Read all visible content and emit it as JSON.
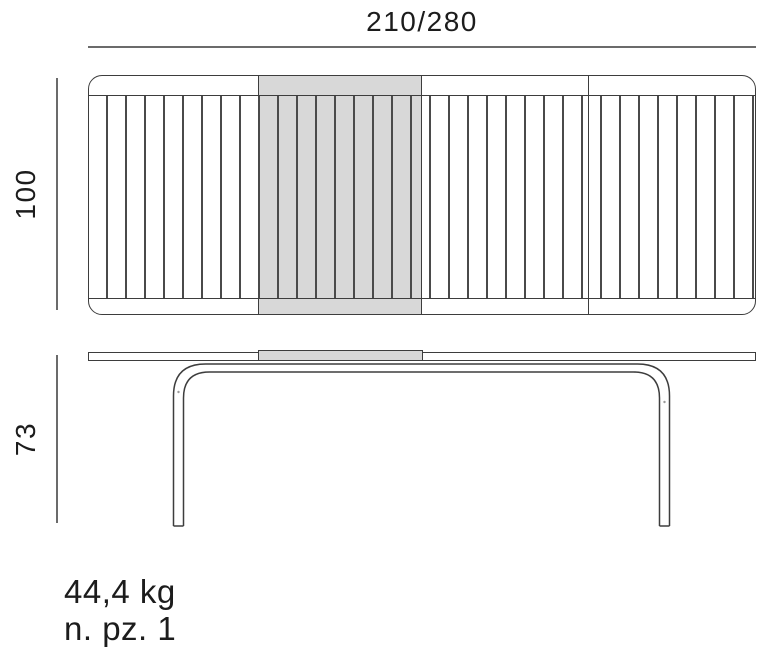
{
  "labels": {
    "width": "210/280",
    "depth": "100",
    "height": "73",
    "weight": "44,4 kg",
    "pieces": "n. pz. 1"
  },
  "colors": {
    "line_color": "#3d3d3d",
    "dim_line_color": "#6b6b6b",
    "leaf_fill": "#d8d8d8",
    "text_color": "#1c1c1c",
    "bg_color": "#ffffff"
  }
}
